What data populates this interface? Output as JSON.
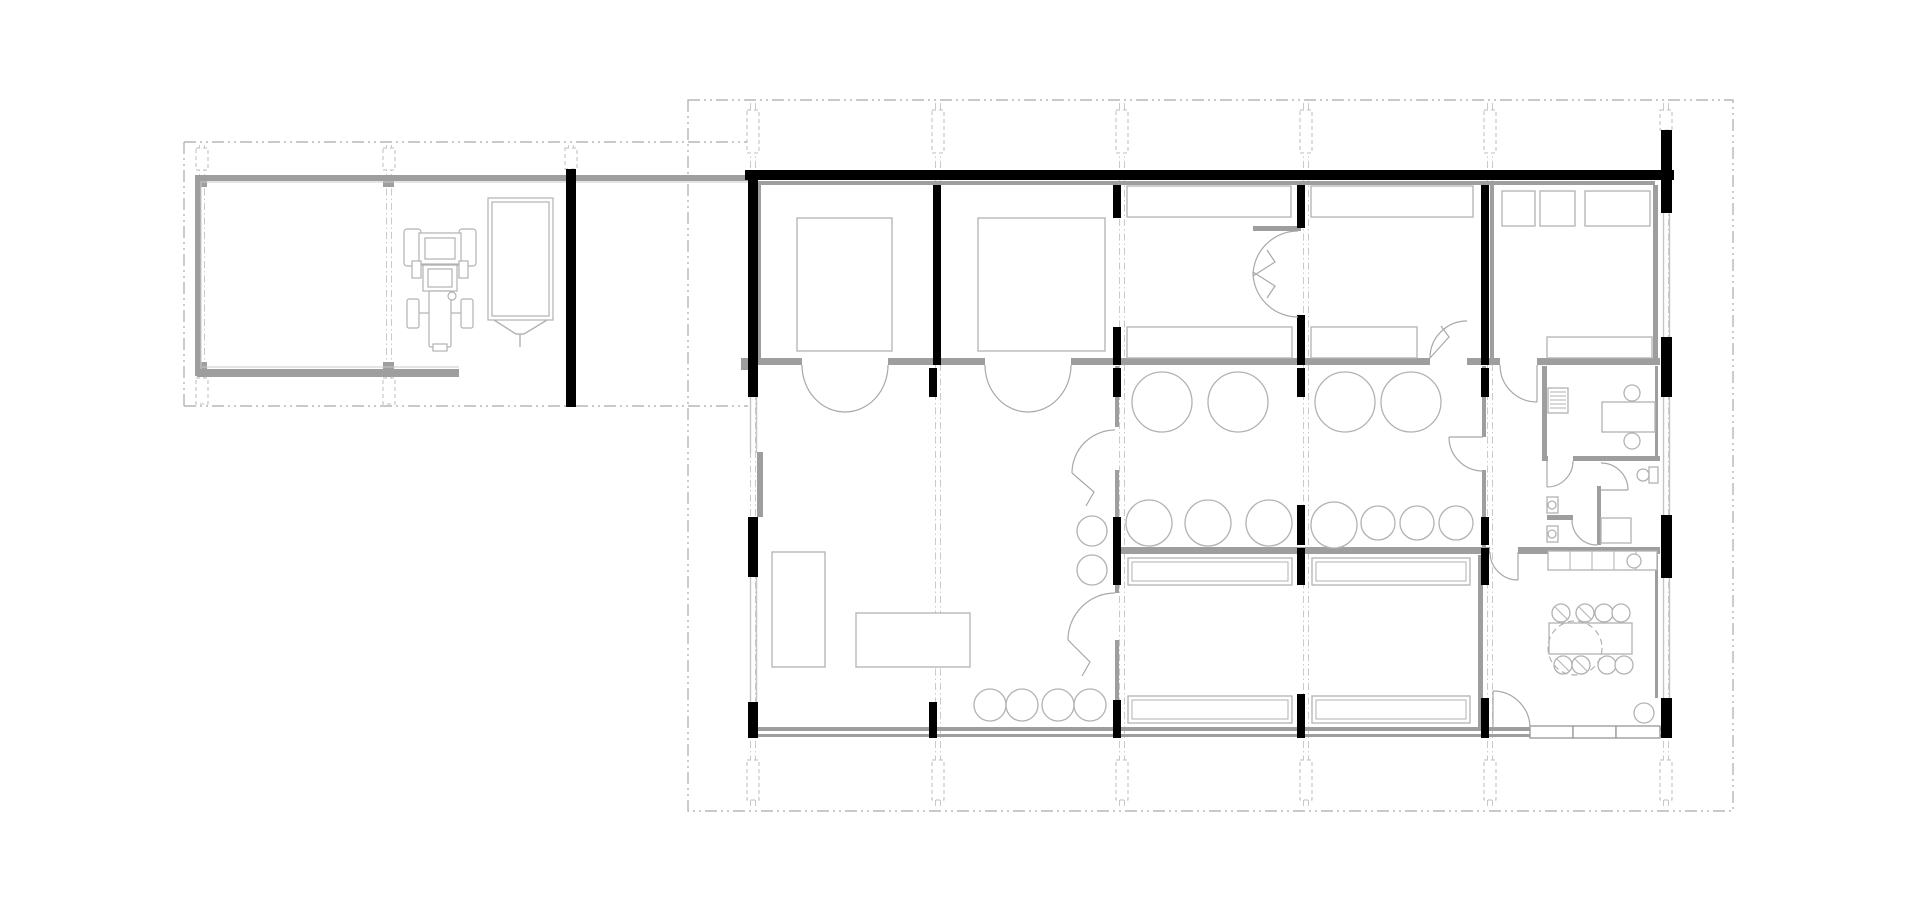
{
  "canvas": {
    "width": 1920,
    "height": 914,
    "background": "#ffffff"
  },
  "colors": {
    "wall_black": "#000000",
    "wall_gray": "#9e9e9e",
    "inner_face": "#c9c9c9",
    "furniture": "#b2b2b2",
    "door": "#a8a8a8",
    "dash_boundary": "#a9a9a9",
    "grid": "#bdbdbd",
    "glass": "#c4c4c4"
  },
  "site_boundary_rect": [
    688,
    100,
    1045,
    711
  ],
  "garage_boundary_lines": [
    [
      184,
      142,
      184,
      406
    ],
    [
      184,
      142,
      748,
      142
    ],
    [
      184,
      406,
      748,
      406
    ]
  ],
  "grid_columns_main": {
    "xs": [
      753,
      938,
      1122,
      1306,
      1490,
      1666
    ],
    "y1": 103,
    "y2": 808
  },
  "grid_columns_garage": {
    "xs": [
      202,
      389,
      571
    ],
    "y1": 145,
    "y2": 404
  },
  "column_markers_dashed": [
    [
      747,
      110,
      12,
      43
    ],
    [
      932,
      110,
      12,
      43
    ],
    [
      1116,
      110,
      12,
      43
    ],
    [
      1300,
      110,
      12,
      43
    ],
    [
      1484,
      110,
      12,
      43
    ],
    [
      1660,
      110,
      12,
      20
    ],
    [
      747,
      760,
      12,
      40
    ],
    [
      932,
      760,
      12,
      40
    ],
    [
      1116,
      760,
      12,
      40
    ],
    [
      1300,
      760,
      12,
      40
    ],
    [
      1484,
      760,
      12,
      40
    ],
    [
      1660,
      760,
      12,
      40
    ],
    [
      196,
      148,
      12,
      22
    ],
    [
      383,
      148,
      12,
      22
    ],
    [
      565,
      148,
      12,
      21
    ],
    [
      196,
      378,
      12,
      26
    ],
    [
      383,
      378,
      12,
      26
    ]
  ],
  "column_squares_gray": [
    [
      196,
      176,
      11,
      11
    ],
    [
      383,
      176,
      11,
      11
    ],
    [
      196,
      362,
      11,
      11
    ],
    [
      383,
      362,
      11,
      11
    ]
  ],
  "walls_gray": [
    [
      197,
      175,
      551,
      6
    ],
    [
      195,
      175,
      6,
      201
    ],
    [
      197,
      369,
      262,
      8
    ],
    [
      741,
      358,
      8,
      12
    ],
    [
      758,
      181,
      897,
      4
    ],
    [
      758,
      185,
      3,
      175
    ],
    [
      1490,
      185,
      4,
      175
    ],
    [
      1653,
      185,
      5,
      175
    ],
    [
      757,
      452,
      6,
      65
    ],
    [
      742,
      358,
      60,
      7
    ],
    [
      888,
      358,
      97,
      7
    ],
    [
      1071,
      358,
      359,
      7
    ],
    [
      1467,
      358,
      33,
      7
    ],
    [
      1537,
      358,
      123,
      7
    ],
    [
      1115,
      547,
      375,
      7
    ],
    [
      1518,
      547,
      142,
      7
    ],
    [
      1115,
      366,
      4,
      61
    ],
    [
      1115,
      470,
      4,
      123
    ],
    [
      1115,
      640,
      4,
      90
    ],
    [
      1482,
      366,
      4,
      71
    ],
    [
      1482,
      470,
      4,
      78
    ],
    [
      1478,
      555,
      5,
      173
    ],
    [
      1542,
      366,
      5,
      95
    ],
    [
      1542,
      456,
      6,
      5
    ],
    [
      1573,
      456,
      87,
      5
    ],
    [
      1547,
      515,
      26,
      5
    ],
    [
      1597,
      486,
      4,
      59
    ],
    [
      1253,
      226,
      48,
      5
    ],
    [
      748,
      727,
      924,
      4
    ],
    [
      748,
      734,
      924,
      3
    ],
    [
      1655,
      366,
      3,
      90
    ],
    [
      1655,
      555,
      3,
      143
    ]
  ],
  "inner_face_lines": [
    [
      202,
      182,
      748,
      182
    ],
    [
      201,
      181,
      201,
      369
    ],
    [
      202,
      367,
      459,
      367
    ]
  ],
  "walls_black": [
    [
      745,
      170,
      929,
      10
    ],
    [
      1661,
      130,
      11,
      83
    ],
    [
      1661,
      337,
      11,
      60
    ],
    [
      1661,
      515,
      11,
      63
    ],
    [
      1661,
      698,
      11,
      40
    ],
    [
      748,
      171,
      10,
      226
    ],
    [
      748,
      517,
      10,
      60
    ],
    [
      748,
      702,
      10,
      36
    ],
    [
      566,
      169,
      10,
      238
    ],
    [
      933,
      185,
      8,
      180
    ],
    [
      1113,
      185,
      8,
      33
    ],
    [
      1113,
      327,
      8,
      38
    ],
    [
      1297,
      185,
      8,
      43
    ],
    [
      1297,
      315,
      8,
      50
    ],
    [
      1481,
      185,
      8,
      180
    ],
    [
      929,
      368,
      8,
      29
    ],
    [
      1113,
      368,
      8,
      29
    ],
    [
      1297,
      368,
      8,
      29
    ],
    [
      1481,
      368,
      8,
      29
    ],
    [
      1297,
      505,
      8,
      40
    ],
    [
      1113,
      517,
      8,
      33
    ],
    [
      1481,
      517,
      8,
      28
    ],
    [
      1113,
      548,
      8,
      37
    ],
    [
      1297,
      548,
      8,
      37
    ],
    [
      1481,
      548,
      8,
      37
    ],
    [
      929,
      702,
      8,
      36
    ],
    [
      1113,
      700,
      8,
      38
    ],
    [
      1297,
      694,
      8,
      44
    ],
    [
      1481,
      698,
      8,
      40
    ]
  ],
  "glazing_vertical": [
    [
      750,
      397,
      56
    ],
    [
      750,
      577,
      125
    ],
    [
      1663,
      213,
      124
    ],
    [
      1663,
      397,
      118
    ],
    [
      1663,
      578,
      120
    ]
  ],
  "door_sills": [
    [
      1530,
      726,
      43,
      12
    ],
    [
      1573,
      726,
      43,
      12
    ],
    [
      1616,
      726,
      44,
      12
    ]
  ],
  "furniture_rects": [
    [
      797,
      218,
      95,
      133
    ],
    [
      978,
      218,
      127,
      133
    ],
    [
      1127,
      186,
      164,
      31
    ],
    [
      1127,
      327,
      165,
      31
    ],
    [
      1311,
      186,
      162,
      31
    ],
    [
      1311,
      327,
      106,
      31
    ],
    [
      1502,
      191,
      33,
      35
    ],
    [
      1540,
      191,
      35,
      35
    ],
    [
      1585,
      191,
      65,
      35
    ],
    [
      1547,
      337,
      105,
      21
    ],
    [
      772,
      552,
      53,
      115
    ],
    [
      856,
      613,
      114,
      54
    ],
    [
      1602,
      402,
      53,
      30
    ],
    [
      1601,
      518,
      30,
      25
    ],
    [
      1549,
      623,
      83,
      31
    ],
    [
      1548,
      551,
      109,
      19
    ],
    [
      1548,
      388,
      20,
      25
    ],
    [
      1547,
      497,
      11,
      16
    ],
    [
      1547,
      526,
      11,
      16
    ],
    [
      1649,
      467,
      9,
      16
    ]
  ],
  "beds_double_rects": [
    [
      1128,
      558,
      164,
      27
    ],
    [
      1312,
      558,
      158,
      27
    ],
    [
      1128,
      696,
      164,
      27
    ],
    [
      1312,
      696,
      158,
      27
    ]
  ],
  "circles": [
    [
      1162,
      402,
      30
    ],
    [
      1238,
      402,
      30
    ],
    [
      1345,
      402,
      30
    ],
    [
      1411,
      402,
      30
    ],
    [
      1149,
      523,
      23
    ],
    [
      1208,
      523,
      23
    ],
    [
      1269,
      523,
      23
    ],
    [
      1334,
      525,
      23
    ],
    [
      1378,
      523,
      17
    ],
    [
      1417,
      523,
      17
    ],
    [
      1456,
      523,
      17
    ],
    [
      1092,
      531,
      15
    ],
    [
      1092,
      570,
      15
    ],
    [
      990,
      705,
      16
    ],
    [
      1022,
      705,
      16
    ],
    [
      1058,
      705,
      16
    ],
    [
      1090,
      705,
      16
    ],
    [
      1561,
      613,
      9
    ],
    [
      1585,
      613,
      9
    ],
    [
      1604,
      613,
      9
    ],
    [
      1621,
      613,
      9
    ],
    [
      1563,
      665,
      9
    ],
    [
      1581,
      665,
      9
    ],
    [
      1607,
      665,
      9
    ],
    [
      1624,
      665,
      9
    ],
    [
      1644,
      713,
      10
    ],
    [
      1632,
      393,
      8
    ],
    [
      1632,
      441,
      8
    ],
    [
      1552,
      505,
      4
    ],
    [
      1552,
      534,
      4
    ],
    [
      1634,
      561,
      7
    ],
    [
      1643,
      475,
      6
    ]
  ],
  "dashed_circles": [
    [
      1575,
      648,
      27
    ]
  ],
  "chair_ticks": [
    [
      1555,
      607,
      1567,
      619
    ],
    [
      1579,
      607,
      1591,
      619
    ],
    [
      1557,
      659,
      1569,
      671
    ],
    [
      1575,
      659,
      1587,
      671
    ]
  ],
  "hatch_lines": [
    [
      1550,
      392,
      1566,
      392
    ],
    [
      1550,
      396,
      1566,
      396
    ],
    [
      1550,
      400,
      1566,
      400
    ],
    [
      1550,
      404,
      1566,
      404
    ],
    [
      1550,
      408,
      1566,
      408
    ]
  ],
  "counter_divider_lines": [
    [
      1570,
      551,
      1570,
      570
    ],
    [
      1592,
      551,
      1592,
      570
    ],
    [
      1614,
      551,
      1614,
      570
    ],
    [
      1636,
      551,
      1636,
      570
    ]
  ],
  "door_paths": [
    "M 802 365 A 43 47 0 0 0 845 412",
    "M 888 365 A 43 47 0 0 1 845 412",
    "M 985 365 A 43 47 0 0 0 1028 412",
    "M 1071 365 A 43 47 0 0 1 1028 412",
    "M 1430 358 A 37 37 0 0 1 1467 321",
    "M 1430 358 L 1449 337 L 1441 326",
    "M 1298 231 A 45 45 0 0 0 1253 276",
    "M 1253 276 L 1275 262 L 1267 250",
    "M 1298 317 A 45 45 0 0 1 1253 272",
    "M 1253 272 L 1275 286 L 1267 298",
    "M 1115 430 A 43 43 0 0 0 1072 473",
    "M 1072 473 L 1094 492 L 1086 506",
    "M 1115 593 A 47 47 0 0 0 1068 640",
    "M 1068 640 L 1090 662 L 1082 676",
    "M 1500 365 A 37 37 0 0 0 1537 402",
    "M 1537 365 L 1537 402",
    "M 1449 437 A 34 34 0 0 0 1483 471",
    "M 1483 437 L 1449 437",
    "M 1573 461 A 26 26 0 0 1 1547 487",
    "M 1547 461 L 1547 487",
    "M 1572 520 A 25 25 0 0 0 1597 545",
    "M 1601 463 A 27 27 0 0 1 1628 490",
    "M 1601 490 L 1628 490",
    "M 1490 552 A 28 28 0 0 0 1518 580",
    "M 1518 552 L 1518 580",
    "M 1530 728 A 37 37 0 0 0 1493 691",
    "M 1493 728 L 1493 691"
  ],
  "tractor": {
    "rects": [
      [
        404,
        229,
        17,
        37,
        3
      ],
      [
        459,
        229,
        17,
        37,
        3
      ],
      [
        419,
        233,
        42,
        31,
        0
      ],
      [
        425,
        238,
        30,
        21,
        0
      ],
      [
        423,
        265,
        34,
        26,
        0
      ],
      [
        428,
        269,
        24,
        18,
        0
      ],
      [
        412,
        261,
        9,
        17,
        0
      ],
      [
        459,
        261,
        9,
        17,
        0
      ],
      [
        429,
        291,
        22,
        56,
        2
      ],
      [
        407,
        299,
        12,
        29,
        2
      ],
      [
        461,
        299,
        12,
        29,
        2
      ],
      [
        433,
        344,
        14,
        7,
        0
      ]
    ],
    "lines": [
      [
        419,
        313,
        429,
        313
      ],
      [
        451,
        313,
        461,
        313
      ],
      [
        421,
        265,
        459,
        265
      ]
    ],
    "circles": [
      [
        452,
        296,
        4
      ]
    ]
  },
  "trailer": {
    "rects": [
      [
        488,
        198,
        65,
        122,
        0
      ],
      [
        492,
        202,
        57,
        114,
        0
      ]
    ],
    "lines": [
      [
        494,
        320,
        516,
        334
      ],
      [
        547,
        320,
        524,
        334
      ],
      [
        516,
        334,
        524,
        334
      ],
      [
        520,
        334,
        520,
        347
      ]
    ]
  }
}
